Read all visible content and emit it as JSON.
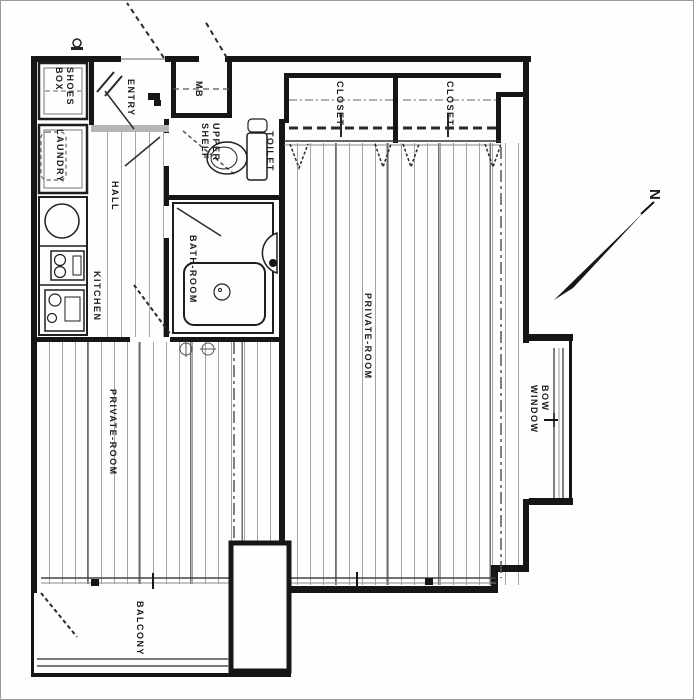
{
  "title": "apartment-floor-plan",
  "rooms": {
    "shoes_box": {
      "label": "SHOES\nBOX"
    },
    "entry": {
      "label": "ENTRY"
    },
    "meter_box": {
      "label": "MB"
    },
    "laundry": {
      "label": "LAUNDRY"
    },
    "hall": {
      "label": "HALL"
    },
    "kitchen": {
      "label": "KITCHEN"
    },
    "upper_shelf": {
      "label": "UPPER\nSHELF"
    },
    "toilet": {
      "label": "TOILET"
    },
    "bathroom": {
      "label": "BATH-ROOM"
    },
    "closet_1": {
      "label": "CLOSET"
    },
    "closet_2": {
      "label": "CLOSET"
    },
    "private_room_right": {
      "label": "PRIVATE-ROOM"
    },
    "private_room_left": {
      "label": "PRIVATE-ROOM"
    },
    "bow_window": {
      "label": "BOW\nWINDOW"
    },
    "balcony": {
      "label": "BALCONY"
    }
  },
  "compass": {
    "north_label": "N"
  },
  "colors": {
    "wall": "#161616",
    "floor_line": "#a3a3a3",
    "label_text": "#1b1b1b",
    "background": "#fefefe"
  }
}
